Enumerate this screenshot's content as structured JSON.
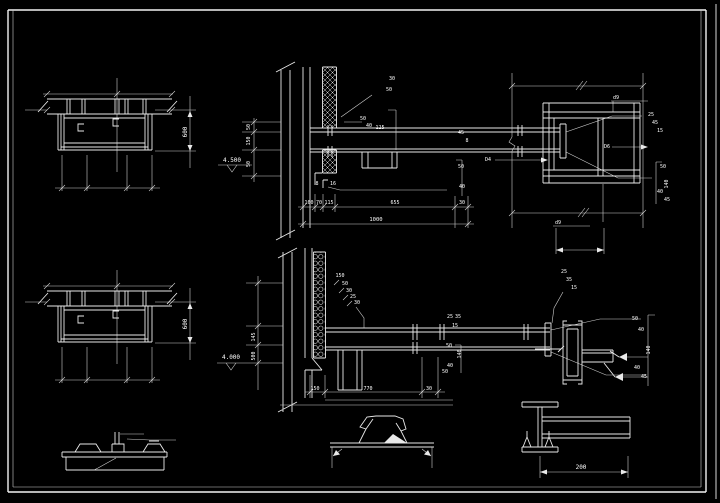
{
  "canvas": {
    "width": 720,
    "height": 503,
    "background": "#000000",
    "line_color": "#e9e9e9",
    "frame_color": "#f2f2f2",
    "text_color": "#ffffff"
  },
  "annotations": [
    {
      "text": "600",
      "x": 187,
      "y": 132,
      "rot": -90
    },
    {
      "text": "600",
      "x": 187,
      "y": 324,
      "rot": -90
    },
    {
      "text": "4.500",
      "x": 232,
      "y": 162
    },
    {
      "text": "50",
      "x": 250,
      "y": 127,
      "rot": -90,
      "size": 5
    },
    {
      "text": "150",
      "x": 250,
      "y": 141,
      "rot": -90,
      "size": 5
    },
    {
      "text": "50",
      "x": 250,
      "y": 164,
      "rot": -90,
      "size": 5
    },
    {
      "text": "30",
      "x": 392,
      "y": 80,
      "size": 5
    },
    {
      "text": "50",
      "x": 389,
      "y": 91,
      "size": 5
    },
    {
      "text": "50",
      "x": 363,
      "y": 120,
      "size": 5
    },
    {
      "text": "40",
      "x": 369,
      "y": 127,
      "size": 5
    },
    {
      "text": "125",
      "x": 380,
      "y": 129,
      "size": 5
    },
    {
      "text": "45",
      "x": 461,
      "y": 134,
      "size": 5
    },
    {
      "text": "8",
      "x": 467,
      "y": 142,
      "size": 5
    },
    {
      "text": "25",
      "x": 651,
      "y": 116,
      "size": 5
    },
    {
      "text": "45",
      "x": 655,
      "y": 124,
      "size": 5
    },
    {
      "text": "15",
      "x": 660,
      "y": 132,
      "size": 5
    },
    {
      "text": "50",
      "x": 663,
      "y": 168,
      "size": 5
    },
    {
      "text": "140",
      "x": 668,
      "y": 184,
      "rot": -90,
      "size": 5
    },
    {
      "text": "40",
      "x": 660,
      "y": 193,
      "size": 5
    },
    {
      "text": "45",
      "x": 667,
      "y": 201,
      "size": 5
    },
    {
      "text": "50",
      "x": 461,
      "y": 168,
      "size": 5
    },
    {
      "text": "40",
      "x": 462,
      "y": 188,
      "size": 5
    },
    {
      "text": "8",
      "x": 317,
      "y": 185,
      "size": 5
    },
    {
      "text": "16",
      "x": 333,
      "y": 185,
      "size": 5
    },
    {
      "text": "160",
      "x": 309,
      "y": 204,
      "size": 5
    },
    {
      "text": "70",
      "x": 319,
      "y": 204,
      "size": 5
    },
    {
      "text": "115",
      "x": 329,
      "y": 204,
      "size": 5
    },
    {
      "text": "655",
      "x": 395,
      "y": 204,
      "size": 5
    },
    {
      "text": "30",
      "x": 462,
      "y": 204,
      "size": 5
    },
    {
      "text": "1000",
      "x": 376,
      "y": 221,
      "size": 5.5
    },
    {
      "text": "d9",
      "x": 616,
      "y": 99,
      "size": 5
    },
    {
      "text": "D6",
      "x": 607,
      "y": 148,
      "size": 5
    },
    {
      "text": "D4",
      "x": 488,
      "y": 161,
      "size": 5
    },
    {
      "text": "d9",
      "x": 558,
      "y": 224,
      "size": 5
    },
    {
      "text": "4.000",
      "x": 231,
      "y": 359
    },
    {
      "text": "145",
      "x": 255,
      "y": 337,
      "rot": -90,
      "size": 5
    },
    {
      "text": "500",
      "x": 255,
      "y": 356,
      "rot": -90,
      "size": 5
    },
    {
      "text": "150",
      "x": 340,
      "y": 277,
      "size": 5
    },
    {
      "text": "50",
      "x": 345,
      "y": 285,
      "size": 5
    },
    {
      "text": "30",
      "x": 349,
      "y": 292,
      "size": 5
    },
    {
      "text": "25",
      "x": 353,
      "y": 298,
      "size": 5
    },
    {
      "text": "30",
      "x": 357,
      "y": 304,
      "size": 5
    },
    {
      "text": "25",
      "x": 564,
      "y": 273,
      "size": 5
    },
    {
      "text": "35",
      "x": 569,
      "y": 281,
      "size": 5
    },
    {
      "text": "15",
      "x": 574,
      "y": 289,
      "size": 5
    },
    {
      "text": "25",
      "x": 450,
      "y": 318,
      "size": 5
    },
    {
      "text": "35",
      "x": 458,
      "y": 318,
      "size": 5
    },
    {
      "text": "15",
      "x": 455,
      "y": 327,
      "size": 5
    },
    {
      "text": "50",
      "x": 449,
      "y": 347,
      "size": 5
    },
    {
      "text": "140",
      "x": 461,
      "y": 354,
      "rot": -90,
      "size": 5
    },
    {
      "text": "40",
      "x": 450,
      "y": 367,
      "size": 5
    },
    {
      "text": "50",
      "x": 445,
      "y": 373,
      "size": 5
    },
    {
      "text": "50",
      "x": 635,
      "y": 320,
      "size": 5
    },
    {
      "text": "40",
      "x": 641,
      "y": 331,
      "size": 5
    },
    {
      "text": "140",
      "x": 650,
      "y": 350,
      "rot": -90,
      "size": 5
    },
    {
      "text": "40",
      "x": 637,
      "y": 369,
      "size": 5
    },
    {
      "text": "45",
      "x": 644,
      "y": 378,
      "size": 5
    },
    {
      "text": "150",
      "x": 315,
      "y": 390,
      "size": 5
    },
    {
      "text": "770",
      "x": 368,
      "y": 390,
      "size": 5
    },
    {
      "text": "30",
      "x": 429,
      "y": 390,
      "size": 5
    },
    {
      "text": "200",
      "x": 581,
      "y": 469
    }
  ]
}
